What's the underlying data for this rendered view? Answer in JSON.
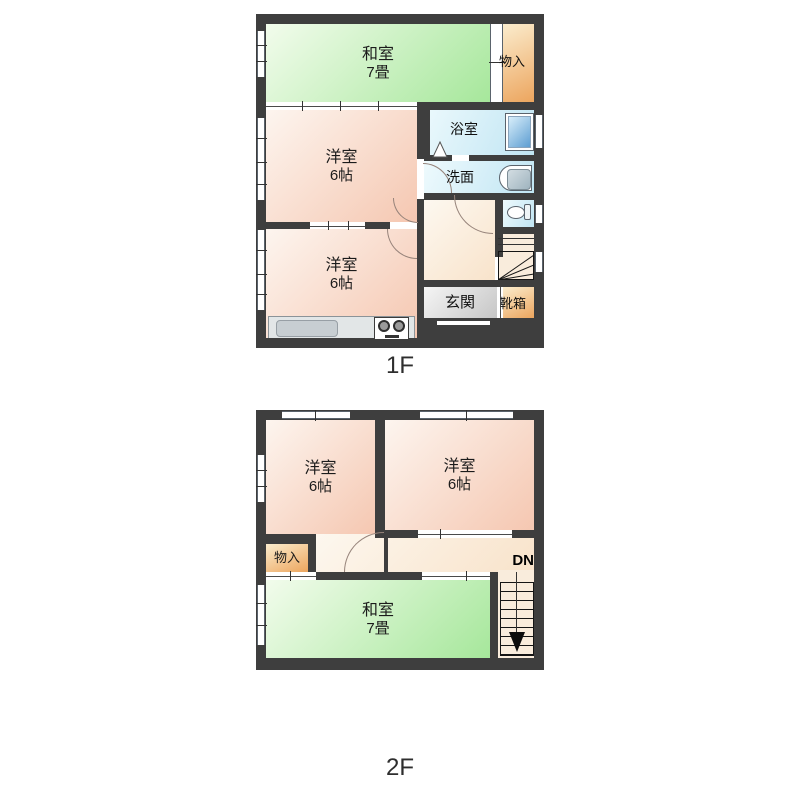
{
  "floor1": {
    "caption": "1F",
    "washitsu": {
      "name": "和室",
      "size": "7畳"
    },
    "monoire": "物入",
    "yoshitsu_upper": {
      "name": "洋室",
      "size": "6帖"
    },
    "yoshitsu_lower": {
      "name": "洋室",
      "size": "6帖"
    },
    "bath": "浴室",
    "senmen": "洗面",
    "genkan": "玄関",
    "kutsubako": "靴箱"
  },
  "floor2": {
    "caption": "2F",
    "yoshitsu_left": {
      "name": "洋室",
      "size": "6帖"
    },
    "yoshitsu_right": {
      "name": "洋室",
      "size": "6帖"
    },
    "monoire": "物入",
    "washitsu": {
      "name": "和室",
      "size": "7畳"
    },
    "stairs_dn": "DN"
  },
  "colors": {
    "wall": "#3e3e3e",
    "tatami_green": "#a6e79b",
    "western_pink": "#f5c7b1",
    "closet_orange": "#eca55e",
    "wet_area_cyan": "#c0e5f3",
    "entry_gray": "#c6c6c6",
    "hall_cream": "#f8e2c9",
    "bathtub_blue": "#5e9ed2",
    "stairs_cream": "#f9ecdc"
  }
}
